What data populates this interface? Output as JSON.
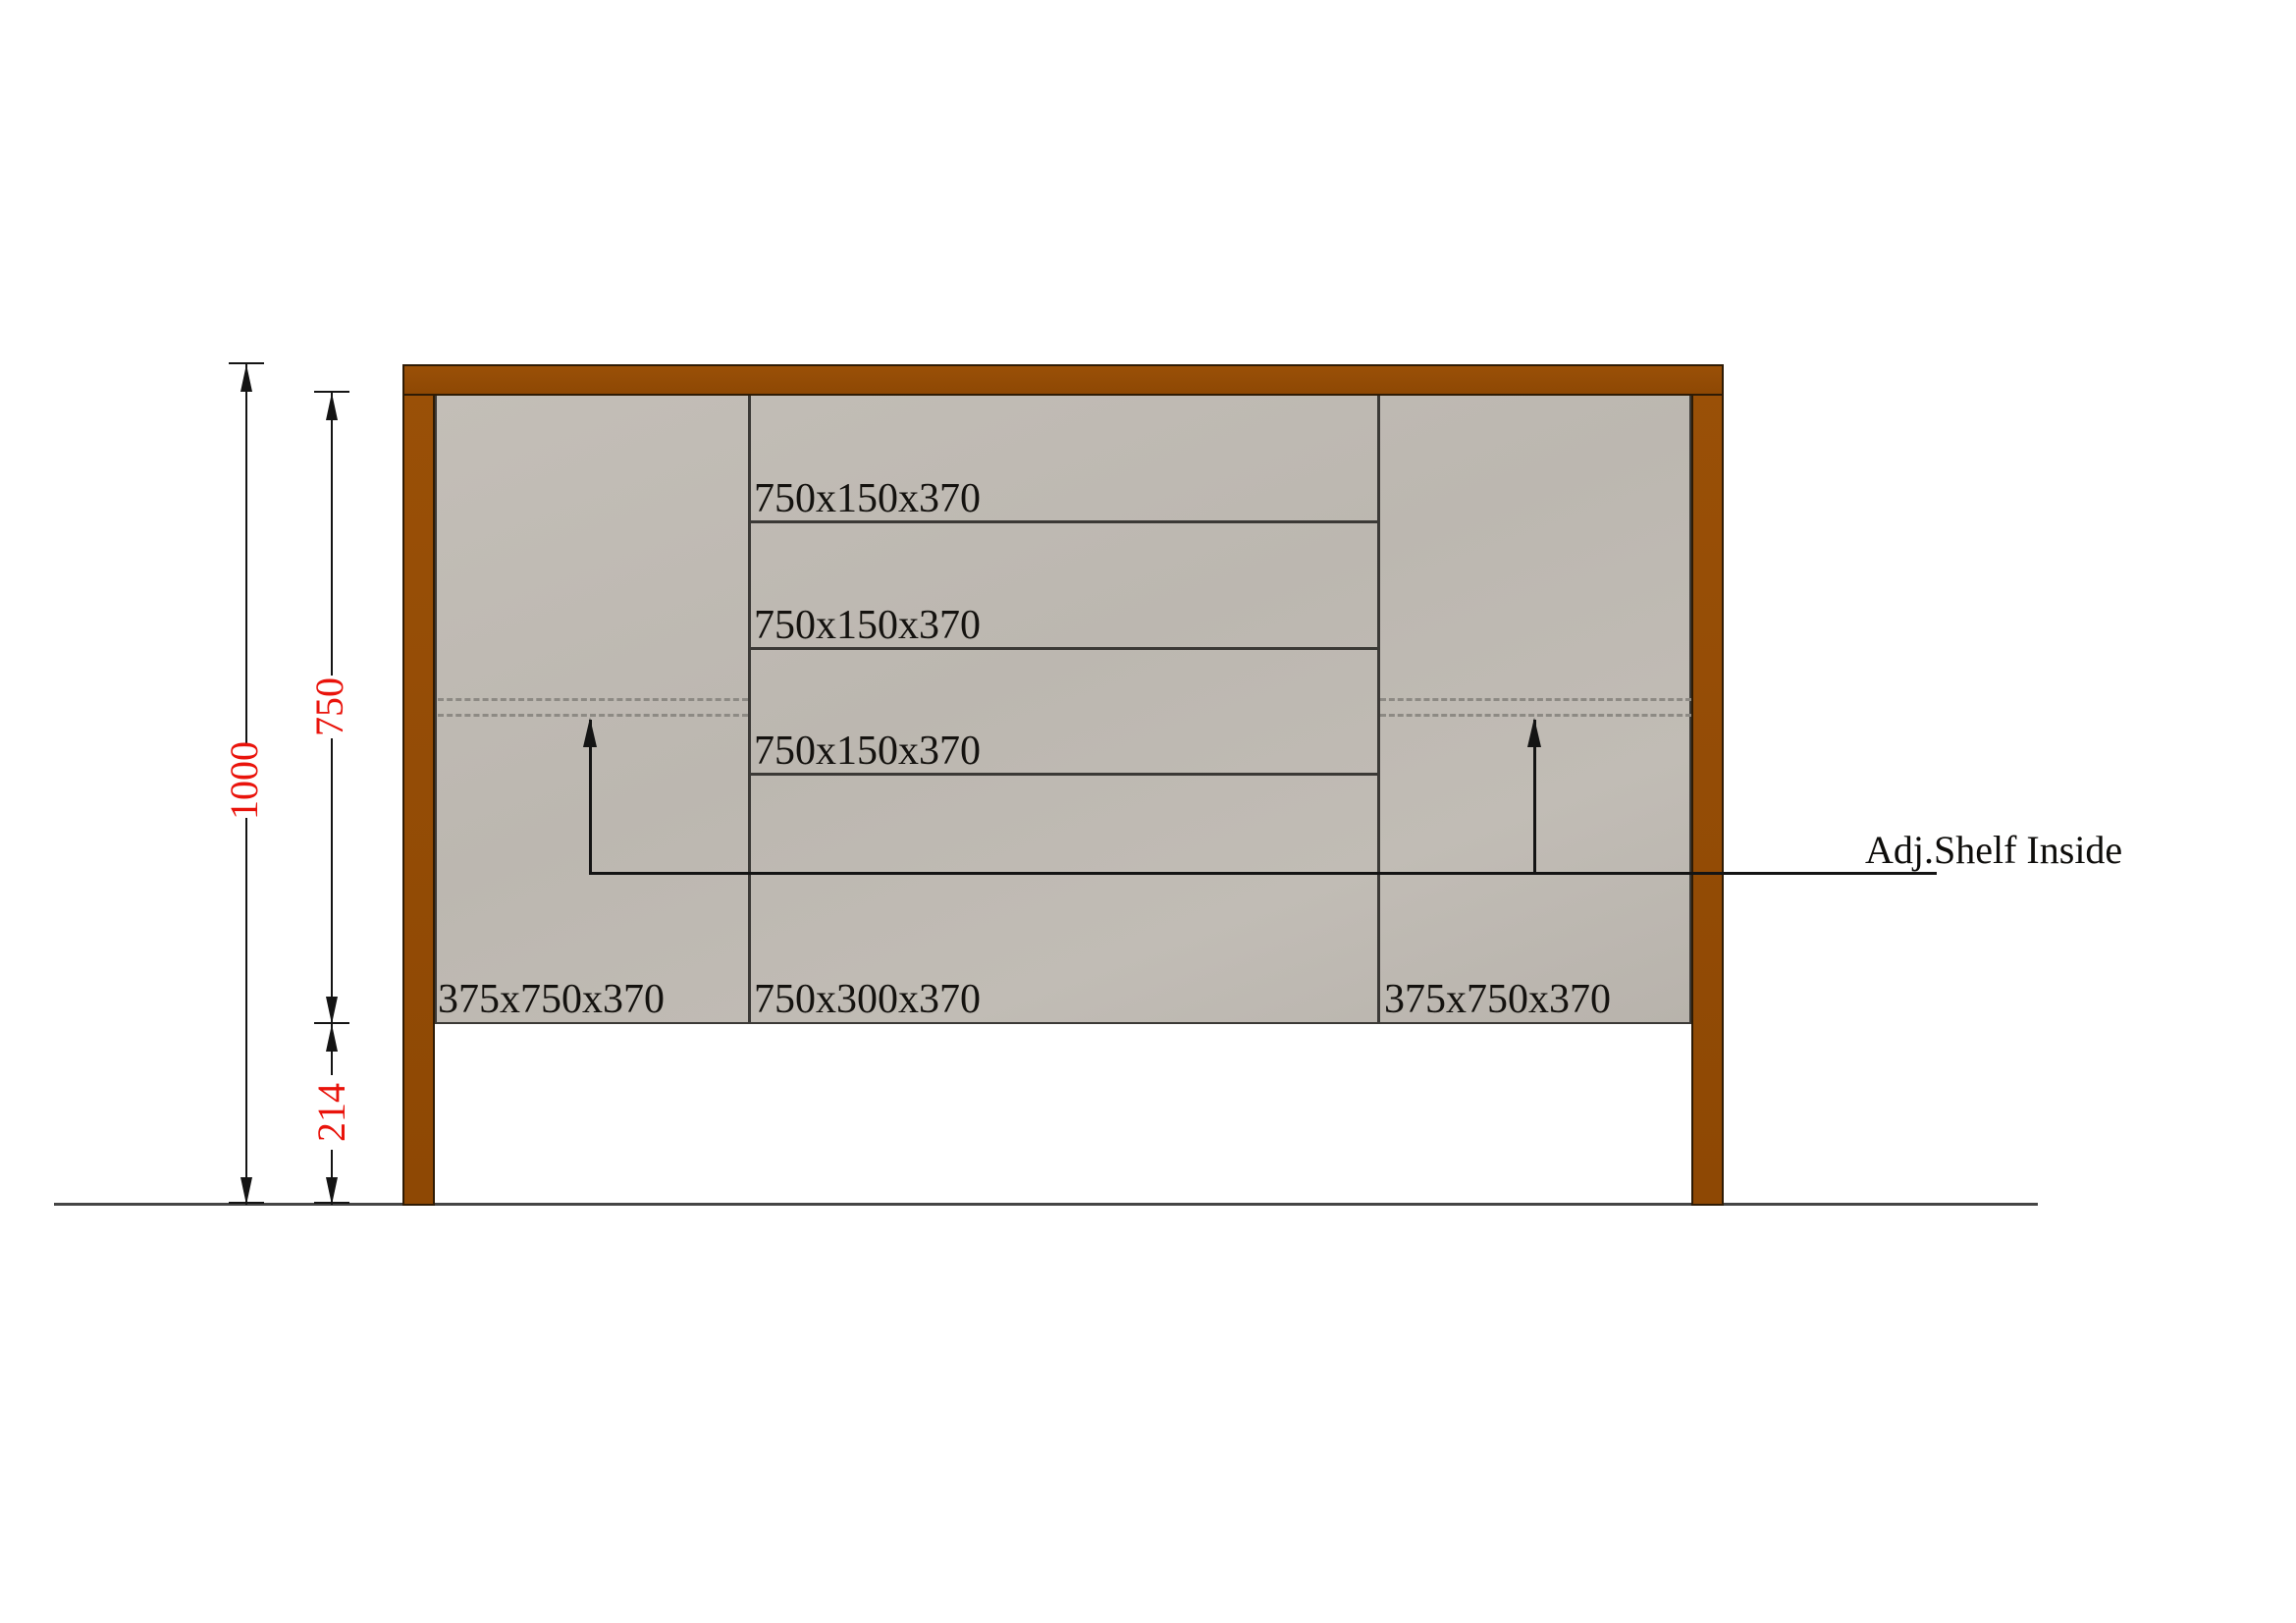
{
  "annotation": {
    "label": "Adj.Shelf Inside"
  },
  "modules": {
    "drawers": [
      "750x150x370",
      "750x150x370",
      "750x150x370"
    ],
    "bottom_center": "750x300x370",
    "left_door": "375x750x370",
    "right_door": "375x750x370"
  },
  "dimensions": {
    "overall_height": "1000",
    "carcase_height": "750",
    "leg_height": "214"
  },
  "colors": {
    "frame": "#9A5007",
    "frame2": "#8E4804",
    "frame-edge": "#2E1B05",
    "panel-edge": "#3B3936",
    "line": "#3B3936",
    "ink": "#141414",
    "red": "#E9130B",
    "dash": "#8D8A84",
    "ground": "#454545"
  }
}
